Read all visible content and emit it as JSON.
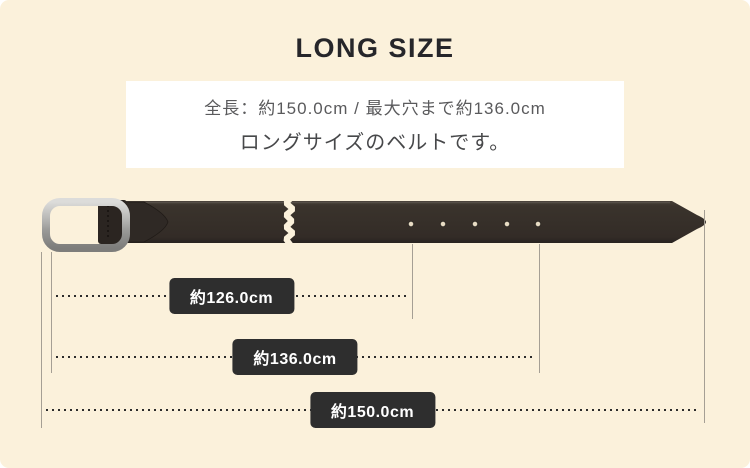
{
  "title": "LONG SIZE",
  "info_box": {
    "line1": "全長：約150.0cm / 最大穴まで約136.0cm",
    "line2": "ロングサイズのベルトです。"
  },
  "measurements": [
    {
      "id": "to-first-hole",
      "label": "約126.0cm"
    },
    {
      "id": "to-max-hole",
      "label": "約136.0cm"
    },
    {
      "id": "total-length",
      "label": "約150.0cm"
    }
  ],
  "colors": {
    "background": "#FBF1DB",
    "info_box_bg": "#FFFFFF",
    "title_text": "#26262A",
    "label_bg": "#2E2E2E",
    "label_text": "#FFFFFF",
    "belt_leather": "#37302A",
    "buckle_metal": "#AEAEAC",
    "guide_line": "#A59F94",
    "dotted_line": "#2B2B2B"
  }
}
